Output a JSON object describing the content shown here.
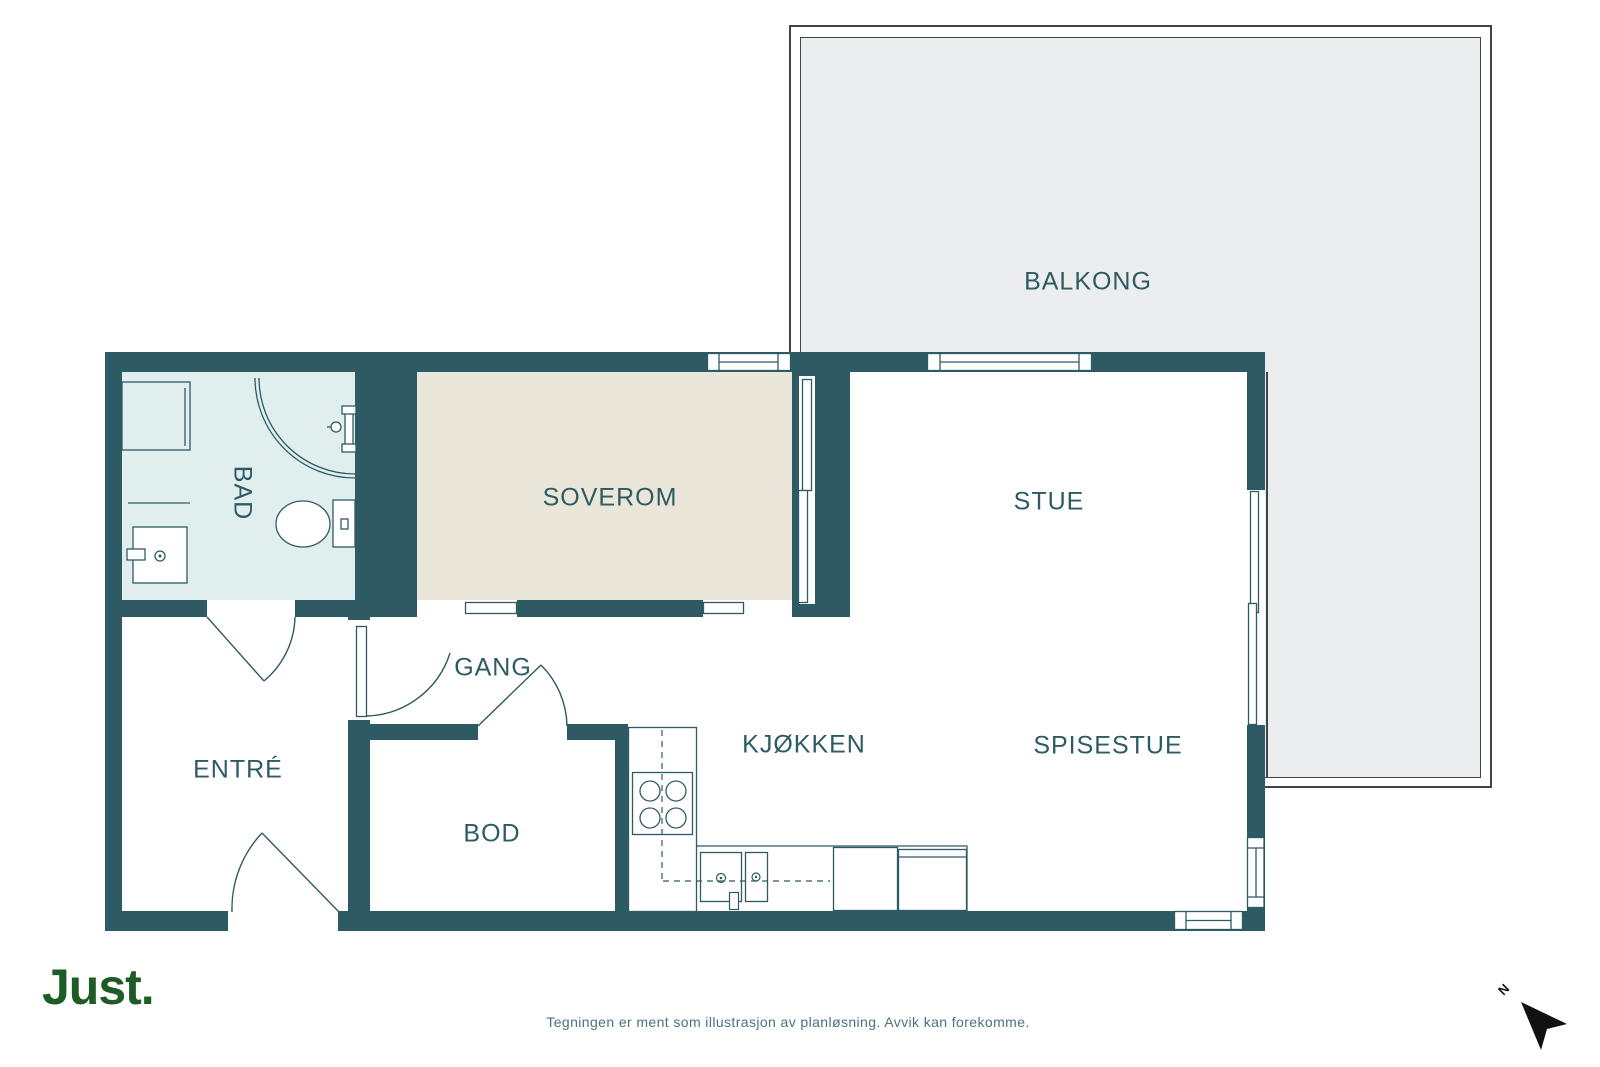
{
  "title": "Floor plan",
  "rooms": {
    "balkong": "BALKONG",
    "soverom": "SOVEROM",
    "stue": "STUE",
    "spisestue": "SPISESTUE",
    "kjokken": "KJØKKEN",
    "gang": "GANG",
    "entre": "ENTRÉ",
    "bod": "BOD",
    "bad": "BAD"
  },
  "footer": {
    "logo": "Just.",
    "disclaimer": "Tegningen er ment som illustrasjon av planløsning. Avvik kan forekomme."
  },
  "compass": {
    "north_label": "N"
  },
  "colors": {
    "wall": "#2e5a63",
    "bathroom_fill": "#e0efee",
    "bedroom_fill": "#eae6da",
    "balcony_fill": "#ebedee",
    "label_text": "#2e5a63",
    "logo_green": "#1d5c24",
    "disclaimer_text": "#4b7280",
    "north_arrow": "#111111"
  }
}
